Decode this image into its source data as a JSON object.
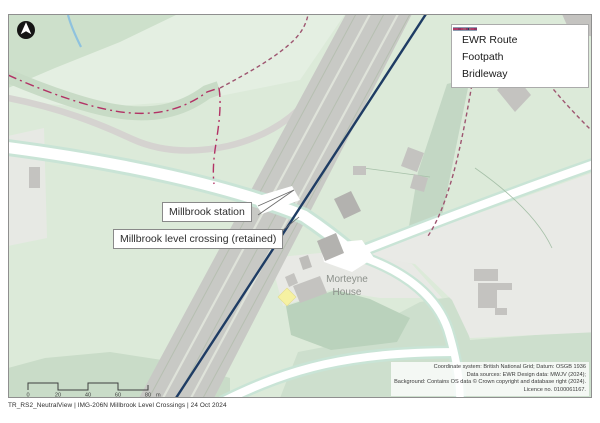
{
  "page": {
    "caption": "TR_RS2_NeutralView | IMG-206N Millbrook Level Crossings | 24 Oct 2024"
  },
  "legend": {
    "items": [
      {
        "label": "EWR Route",
        "style": "solid",
        "color": "#1e3c64"
      },
      {
        "label": "Footpath",
        "style": "dashed",
        "color": "#9e5570"
      },
      {
        "label": "Bridleway",
        "style": "dash-dot",
        "color": "#b23265"
      }
    ]
  },
  "map_labels": {
    "station": "Millbrook station",
    "level_crossing": "Millbrook level crossing (retained)",
    "morteyne_line1": "Morteyne",
    "morteyne_line2": "House"
  },
  "scalebar": {
    "ticks": [
      "0",
      "20",
      "40",
      "60",
      "80"
    ],
    "unit": "m"
  },
  "attribution": {
    "line1": "Coordinate system: British National Grid; Datum: OSGB 1936",
    "line2": "Data sources: EWR Design data: MWJV (2024);",
    "line3": "Background: Contains OS data © Crown copyright and database right (2024).",
    "line4": "Licence no. 0100061167."
  },
  "colors": {
    "ewr_route": "#1e3c64",
    "footpath": "#9e5570",
    "bridleway": "#b23265",
    "marker_yellow": "#f6f1a2",
    "stream_blue": "#8fc2de"
  }
}
